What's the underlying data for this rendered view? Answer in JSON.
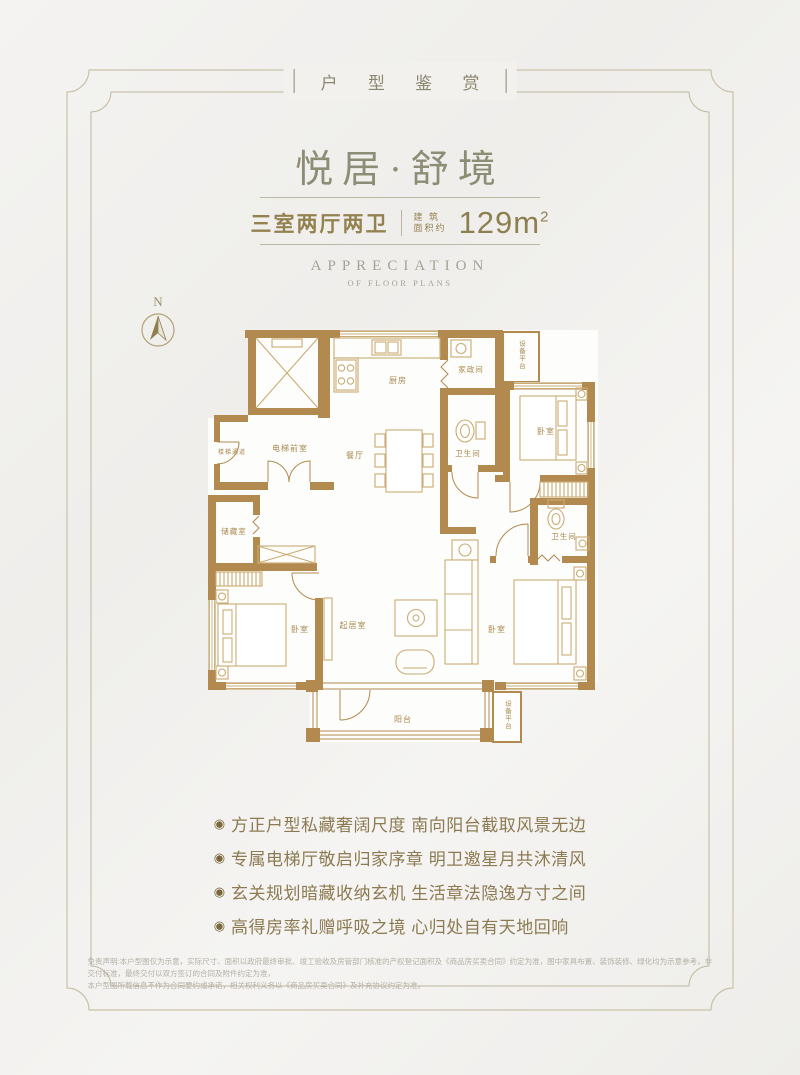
{
  "page": {
    "bg": "#f2f1ee",
    "frame_outer_color": "#c9c3ac",
    "frame_inner_color": "#beb89f"
  },
  "header_tag": {
    "text": "户 型 鉴 赏"
  },
  "title": "悦居·舒境",
  "spec": {
    "layout": "三室两厅两卫",
    "area_label_top": "建 筑",
    "area_label_bottom": "面积约",
    "area_value": "129m",
    "area_sup": "2"
  },
  "subtitle_en": {
    "line1": "APPRECIATION",
    "line2": "OF FLOOR PLANS"
  },
  "compass": {
    "label": "N"
  },
  "floorplan": {
    "wall_color": "#b2894e",
    "furniture_color": "#c9ac74",
    "label_color": "#a8894f",
    "labels": {
      "stair": "楼梯通道",
      "lobby": "电梯前室",
      "kitchen": "厨房",
      "laundry": "家政间",
      "equip_top": "设备平台",
      "bath1": "卫生间",
      "bed1": "卧室",
      "dining": "餐厅",
      "storage": "储藏室",
      "bath2": "卫生间",
      "bed2": "卧室",
      "living": "起居室",
      "bed3": "卧室",
      "balcony": "阳台",
      "equip_bottom": "设备平台"
    }
  },
  "features": {
    "bullet": "◉",
    "items": [
      "方正户型私藏奢阔尺度 南向阳台截取风景无边",
      "专属电梯厅敬启归家序章 明卫邀星月共沐清风",
      "玄关规划暗藏收纳玄机 生活章法隐逸方寸之间",
      "高得房率礼赠呼吸之境 心归处自有天地回响"
    ]
  },
  "disclaimer": {
    "line1": "免责声明:本户型图仅为示意，实际尺寸、面积以政府最终审批、竣工验收及房管部门核准的产权登记面积及《商品房买卖合同》约定为准，图中家具布置、装饰装修、绿化均为示意参考，非交付标准，最终交付以双方签订的合同及附件约定为准，",
    "line2": "本户型图所载信息不作为合同要约或承诺，相关权利义务以《商品房买卖合同》及补充协议约定为准。"
  }
}
